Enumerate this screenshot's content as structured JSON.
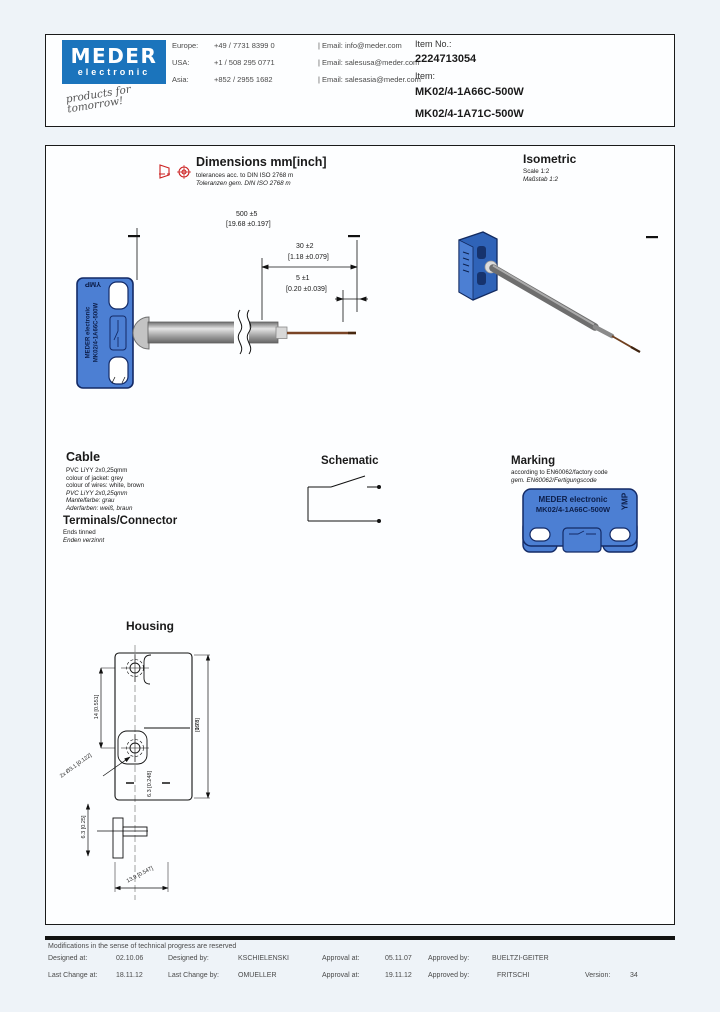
{
  "header": {
    "logo_line1": "MEDER",
    "logo_line2": "electronic",
    "tagline": "products for tomorrow!",
    "contacts": [
      {
        "region": "Europe:",
        "phone": "+49 / 7731 8399 0",
        "email": "| Email: info@meder.com"
      },
      {
        "region": "USA:",
        "phone": "+1 / 508 295 0771",
        "email": "| Email: salesusa@meder.com"
      },
      {
        "region": "Asia:",
        "phone": "+852 / 2955 1682",
        "email": "| Email: salesasia@meder.com"
      }
    ],
    "item_no_label": "Item No.:",
    "item_no": "2224713054",
    "item_label": "Item:",
    "item_1": "MK02/4-1A66C-500W",
    "item_2": "MK02/4-1A71C-500W"
  },
  "dimensions_section": {
    "title": "Dimensions mm[inch]",
    "tolerance_en": "tolerances acc. to DIN ISO 2768 m",
    "tolerance_de": "Toleranzen gem. DIN ISO 2768 m",
    "dim_cable_mm": "500 ±5",
    "dim_cable_inch": "[19.68 ±0.197]",
    "dim_strip_mm": "30 ±2",
    "dim_strip_inch": "[1.18 ±0.079]",
    "dim_tin_mm": "5 ±1",
    "dim_tin_inch": "[0.20 ±0.039]",
    "sensor_text_line1": "MEDER electronic",
    "sensor_text_line2": "MK02/4-1A66C-500W",
    "sensor_marking": "YMP"
  },
  "isometric_section": {
    "title": "Isometric",
    "scale_en": "Scale 1:2",
    "scale_de": "Maßstab 1:2"
  },
  "cable_section": {
    "title": "Cable",
    "en": [
      "PVC LiYY 2x0,25qmm",
      "colour of jacket: grey",
      "colour of wires: white, brown"
    ],
    "de": [
      "PVC LiYY 2x0,25qmm",
      "Mantelfarbe: grau",
      "Aderfarben: weiß, braun"
    ]
  },
  "terminals_section": {
    "title": "Terminals/Connector",
    "en": "Ends tinned",
    "de": "Enden verzinnt"
  },
  "schematic_section": {
    "title": "Schematic"
  },
  "marking_section": {
    "title": "Marking",
    "en": "according to EN60062/factory code",
    "de": "gem. EN60062/Fertigungscode",
    "body_line1": "MEDER electronic",
    "body_line2": "MK02/4-1A66C-500W",
    "side_marking": "YMP"
  },
  "housing_section": {
    "title": "Housing",
    "dim_hole_spacing": "14 [0.551]",
    "dim_height_mm": "19.8",
    "dim_height_inch": "[0.78]",
    "dim_holes": "2x Ø3.1 [0.122]",
    "dim_gap": "6.3 [0.248]",
    "dim_depth": "6.3 [0.25]",
    "dim_width": "13.9 [0.547]"
  },
  "footer": {
    "note": "Modifications in the sense of technical progress are reserved",
    "row1": {
      "l1": "Designed at:",
      "v1": "02.10.06",
      "l2": "Designed by:",
      "v2": "KSCHIELENSKI",
      "l3": "Approval at:",
      "v3": "05.11.07",
      "l4": "Approved by:",
      "v4": "BUELTZI-GEITER"
    },
    "row2": {
      "l1": "Last Change at:",
      "v1": "18.11.12",
      "l2": "Last Change by:",
      "v2": "OMUELLER",
      "l3": "Approval at:",
      "v3": "19.11.12",
      "l4": "Approved by:",
      "v4": "FRITSCHI",
      "l5": "Version:",
      "v5": "34"
    }
  }
}
